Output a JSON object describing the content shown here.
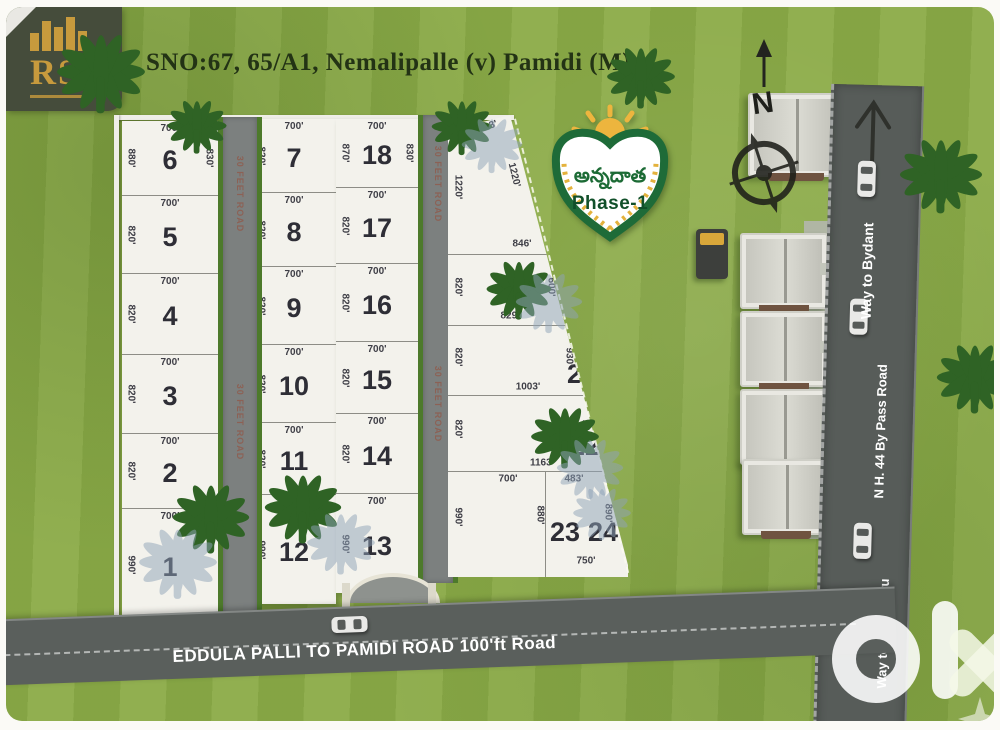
{
  "title": "SNO:67, 65/A1, Nemalipalle (v) Pamidi (M)",
  "brand": {
    "initials": "RS"
  },
  "badge": {
    "telugu": "అన్నదాత",
    "phase": "Phase-1"
  },
  "compass": {
    "north": "N"
  },
  "watermark": "olx",
  "roads": {
    "internal_label": "30 FEET ROAD",
    "bottom_label": "EDDULA PALLI TO PAMIDI ROAD 100'ft Road",
    "highway_label": "N H. 44 By Pass Road",
    "way_north": "Way to Bydant",
    "way_south": "Way to Bengaluru"
  },
  "colors": {
    "grass": "#8dac49",
    "road": "#575c59",
    "plot_white": "#f3f2ec",
    "accent_green": "#1c6b35",
    "gold": "#e4b23c"
  },
  "plot_columns": [
    {
      "id": "A",
      "plots": [
        {
          "no": "6",
          "top": "700'",
          "left": "880'",
          "right": "830'"
        },
        {
          "no": "5",
          "top": "700'",
          "left": "820'"
        },
        {
          "no": "4",
          "top": "700'",
          "left": "820'"
        },
        {
          "no": "3",
          "top": "700'",
          "left": "820'"
        },
        {
          "no": "2",
          "top": "700'",
          "left": "820'"
        },
        {
          "no": "1",
          "top": "700'",
          "left": "990'"
        }
      ]
    },
    {
      "id": "B",
      "plots": [
        {
          "no": "7",
          "top": "700'",
          "left": "820'"
        },
        {
          "no": "8",
          "top": "700'",
          "left": "820'"
        },
        {
          "no": "9",
          "top": "700'",
          "left": "820'"
        },
        {
          "no": "10",
          "top": "700'",
          "left": "820'"
        },
        {
          "no": "11",
          "top": "700'",
          "left": "820'"
        },
        {
          "no": "12",
          "top": "700'",
          "left": "990'"
        }
      ]
    },
    {
      "id": "C",
      "plots": [
        {
          "no": "18",
          "top": "700'",
          "left": "870'",
          "right": "830'"
        },
        {
          "no": "17",
          "top": "700'",
          "left": "820'"
        },
        {
          "no": "16",
          "top": "700'",
          "left": "820'"
        },
        {
          "no": "15",
          "top": "700'",
          "left": "820'"
        },
        {
          "no": "14",
          "top": "700'",
          "left": "820'"
        },
        {
          "no": "13",
          "top": "700'",
          "left": "990'"
        }
      ]
    },
    {
      "id": "D",
      "plots": [
        {
          "no": "19",
          "top": "303'",
          "left": "1220'",
          "right": "1220'",
          "bottom": "846'"
        },
        {
          "no": "20",
          "left": "820'",
          "right": "600'",
          "bottom": "829'"
        },
        {
          "no": "21",
          "left": "820'",
          "right": "930'",
          "bottom": "1003'"
        },
        {
          "no": "22",
          "left": "820'",
          "right": "950'",
          "bottom": "1163'"
        },
        {
          "no": "23",
          "top": "700'",
          "left": "990'",
          "right": "880'"
        },
        {
          "no": "24",
          "top": "483'",
          "right": "890'",
          "bottom": "750'"
        }
      ]
    }
  ]
}
